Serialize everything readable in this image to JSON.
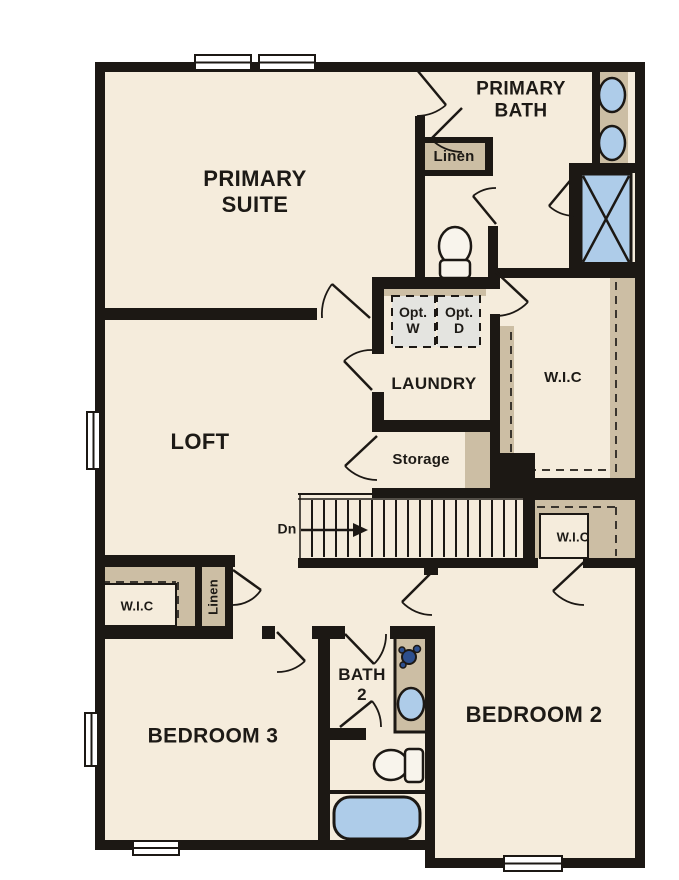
{
  "plan": {
    "type": "floor-plan",
    "floor": "second-floor",
    "labels": {
      "primary_suite": "PRIMARY\nSUITE",
      "primary_bath": "PRIMARY\nBATH",
      "linen_top": "Linen",
      "opt_w": "Opt.\nW",
      "opt_d": "Opt.\nD",
      "laundry": "LAUNDRY",
      "wic_primary": "W.I.C",
      "storage": "Storage",
      "stairs_direction": "Dn",
      "wic_bedroom2": "W.I.C",
      "loft": "LOFT",
      "wic_bedroom3": "W.I.C",
      "linen_hall": "Linen",
      "bath2": "BATH\n2",
      "bedroom3": "BEDROOM 3",
      "bedroom2": "BEDROOM 2"
    },
    "rooms": [
      "PRIMARY SUITE",
      "PRIMARY BATH",
      "LAUNDRY",
      "LOFT",
      "STORAGE",
      "W.I.C (primary)",
      "W.I.C (bedroom 2)",
      "W.I.C (bedroom 3)",
      "BATH 2",
      "BEDROOM 2",
      "BEDROOM 3"
    ],
    "fixtures": [
      "double-vanity-sinks",
      "shower",
      "toilet-primary",
      "linen-closet-top",
      "optional-washer",
      "optional-dryer",
      "stairs-down",
      "bath2-vanity-sink",
      "toilet-bath2",
      "bathtub",
      "linen-closet-hall"
    ],
    "colors": {
      "wall": "#1c1814",
      "floor": "#f5ecdc",
      "closet_tan": "#ccbea4",
      "fixture_blue": "#aecce9",
      "optional_gray": "#e4e4e0",
      "fixture_accent_blue": "#2d4f8e",
      "background": "#ffffff",
      "text": "#1d1a16"
    }
  }
}
